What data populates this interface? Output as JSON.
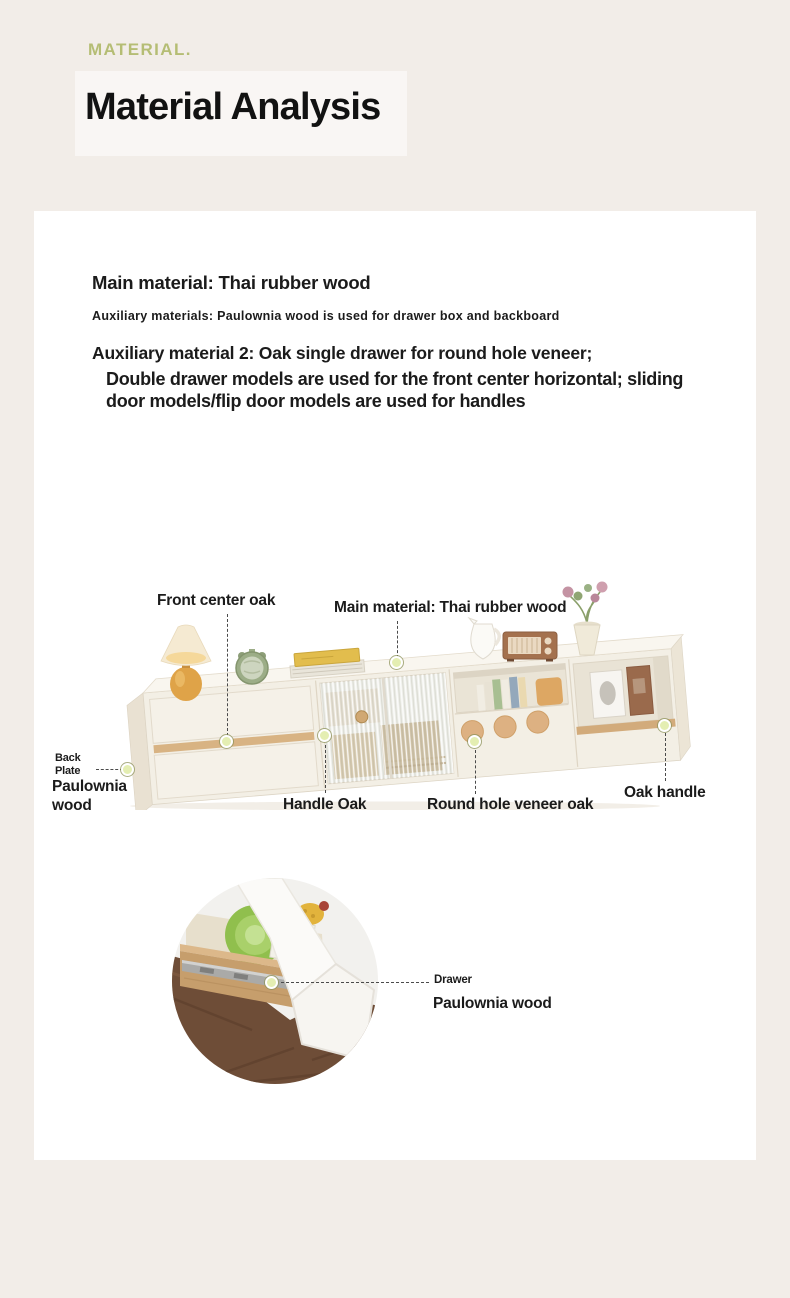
{
  "header": {
    "eyebrow": "MATERIAL.",
    "title": "Material Analysis"
  },
  "intro": {
    "main": "Main material: Thai rubber wood",
    "aux1": "Auxiliary materials: Paulownia wood is used for drawer box and backboard",
    "aux2": "Auxiliary material 2: Oak single drawer for round hole veneer;",
    "aux2_detail_line1": "Double drawer models are used for the front center horizontal; sliding",
    "aux2_detail_line2": "door models/flip door models are used for handles"
  },
  "diagram": {
    "callouts": [
      {
        "label": "Front center oak"
      },
      {
        "label": "Main material: Thai rubber wood"
      },
      {
        "label": "Back Plate"
      },
      {
        "label": "Paulownia wood"
      },
      {
        "label": "Handle Oak"
      },
      {
        "label": "Round hole veneer oak"
      },
      {
        "label": "Oak handle"
      }
    ]
  },
  "detail": {
    "callout_small": "Drawer",
    "callout_main": "Paulownia wood"
  },
  "colors": {
    "background": "#f2ede8",
    "card": "#ffffff",
    "eyebrow_green": "#b5bd74",
    "marker_fill": "#e4eeb2",
    "oak_accent": "#d8b383",
    "text": "#1b1b1b"
  }
}
